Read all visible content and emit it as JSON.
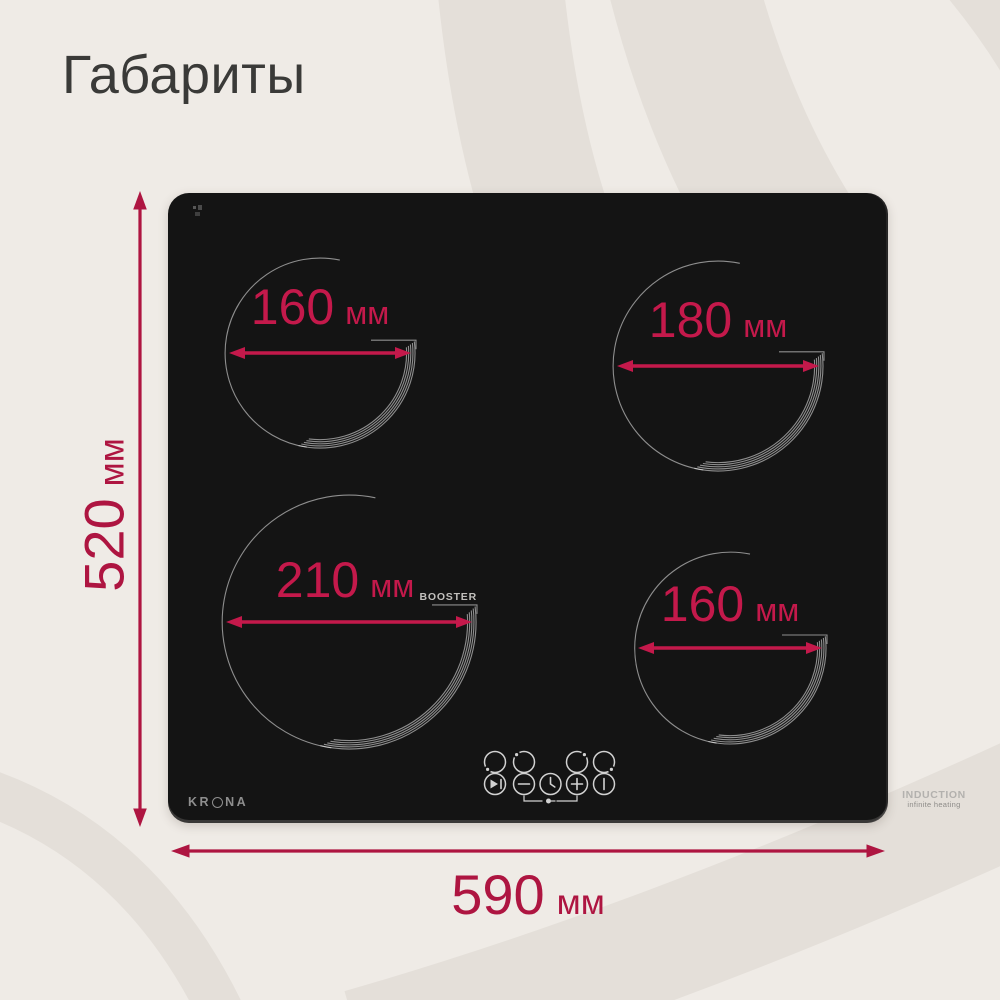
{
  "title": "Габариты",
  "colors": {
    "background": "#efebe6",
    "pattern_band": "#e4dfd9",
    "cooktop_surface": "#141414",
    "accent_on_dark": "#c4194b",
    "accent_on_light": "#ae1541",
    "control_gray": "#d2d2d2",
    "brand_gray": "#8e8e8e"
  },
  "overall_dimensions": {
    "height": {
      "value": "520",
      "unit": "мм"
    },
    "width": {
      "value": "590",
      "unit": "мм"
    }
  },
  "burners": [
    {
      "position": "top-left",
      "diameter": {
        "value": "160",
        "unit": "мм"
      }
    },
    {
      "position": "top-right",
      "diameter": {
        "value": "180",
        "unit": "мм"
      }
    },
    {
      "position": "bottom-left",
      "diameter": {
        "value": "210",
        "unit": "мм"
      },
      "feature": "BOOSTER"
    },
    {
      "position": "bottom-right",
      "diameter": {
        "value": "160",
        "unit": "мм"
      }
    }
  ],
  "cooktop": {
    "brand": {
      "name": "KRONA",
      "prefix": "KR",
      "suffix": "NA"
    },
    "badge": {
      "line1": "INDUCTION",
      "line2": "infinite heating"
    },
    "booster_label": "BOOSTER",
    "controls": {
      "selector_icons": [
        "burner-selector-front-left-icon",
        "burner-selector-back-left-icon",
        "burner-selector-back-right-icon",
        "burner-selector-front-right-icon"
      ],
      "function_icons": [
        "pause-icon",
        "minus-icon",
        "timer-icon",
        "plus-icon",
        "power-icon",
        "child-lock-icon"
      ]
    }
  }
}
